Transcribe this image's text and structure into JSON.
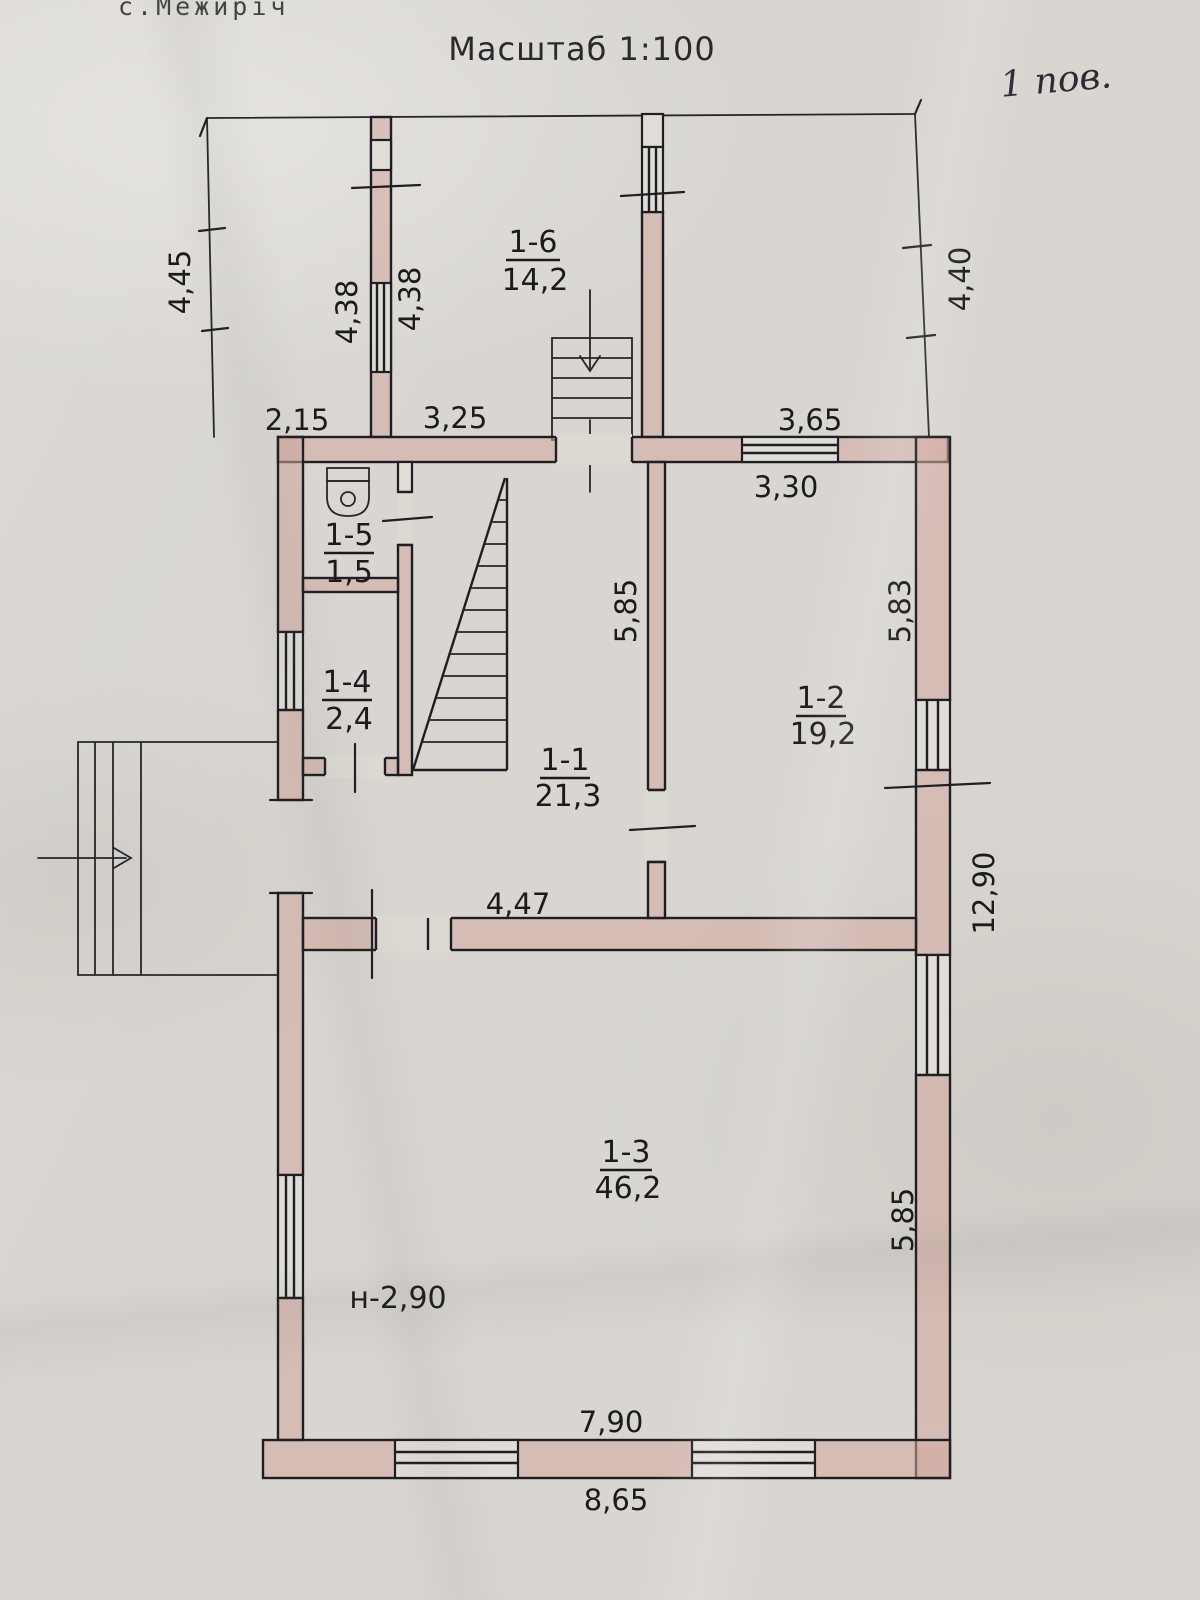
{
  "header": {
    "location": "с.Межиріч",
    "scale": "Масштаб 1:100",
    "floor_note": "1 пов."
  },
  "rooms": {
    "r16": {
      "id": "1-6",
      "area": "14,2"
    },
    "r15": {
      "id": "1-5",
      "area": "1,5"
    },
    "r14": {
      "id": "1-4",
      "area": "2,4"
    },
    "r11": {
      "id": "1-1",
      "area": "21,3"
    },
    "r12": {
      "id": "1-2",
      "area": "19,2"
    },
    "r13": {
      "id": "1-3",
      "area": "46,2"
    }
  },
  "dims": {
    "veranda_left": "4,45",
    "veranda_mid_left": "4,38",
    "veranda_mid_right": "4,38",
    "veranda_right": "4,40",
    "veranda_bottom_left": "2,15",
    "veranda_bottom_mid": "3,25",
    "veranda_window": "3,65",
    "room12_width": "3,30",
    "room11_depth": "5,85",
    "room12_depth": "5,83",
    "room11_width": "4,47",
    "east_total": "12,90",
    "room13_depth": "5,85",
    "room13_window_span": "7,90",
    "south_total": "8,65",
    "height_note": "н-2,90"
  }
}
